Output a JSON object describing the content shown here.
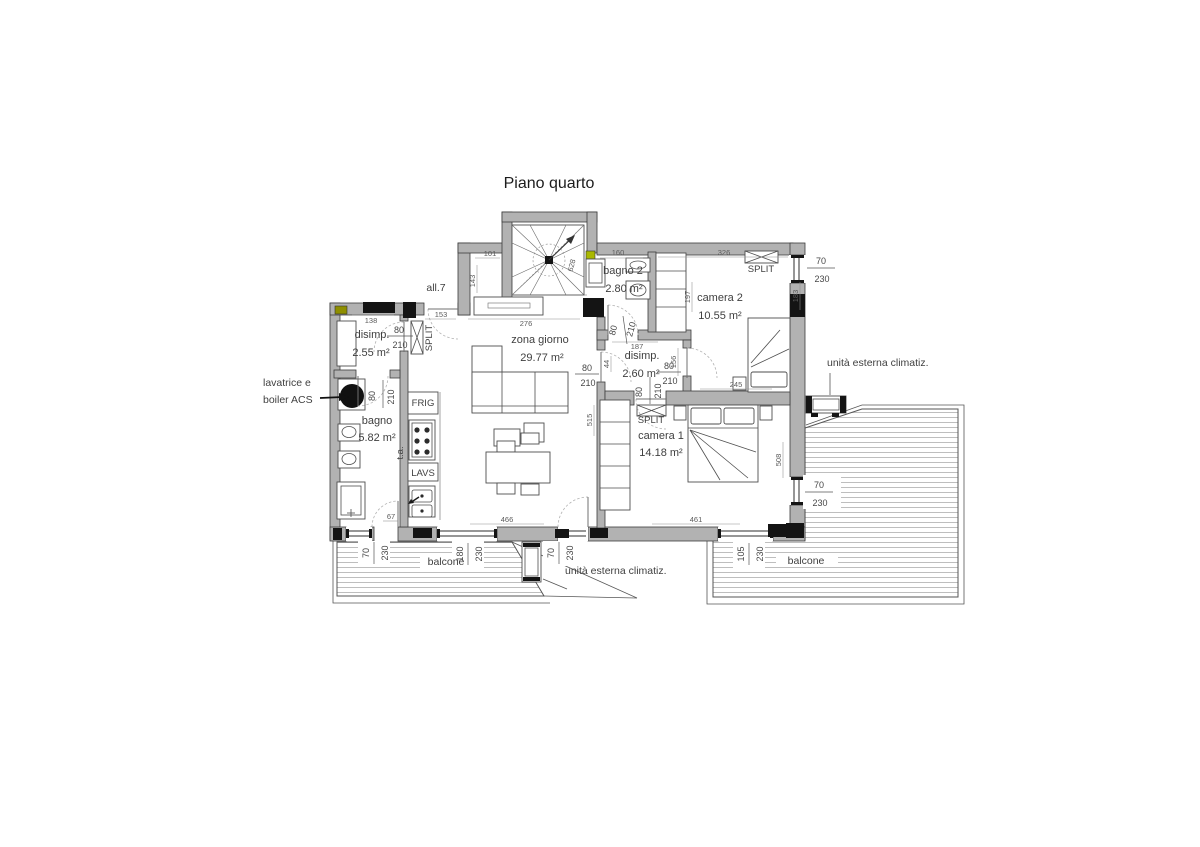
{
  "title": "Piano quarto",
  "rooms": {
    "disimp1": {
      "name": "disimp.",
      "area": "2.55 m²"
    },
    "bagno": {
      "name": "bagno",
      "area": "5.82 m²"
    },
    "zona": {
      "name": "zona giorno",
      "area": "29.77 m²"
    },
    "bagno2": {
      "name": "bagno 2",
      "area": "2.80 m²"
    },
    "camera2": {
      "name": "camera 2",
      "area": "10.55 m²"
    },
    "disimp2": {
      "name": "disimp.",
      "area": "2.60 m²"
    },
    "camera1": {
      "name": "camera 1",
      "area": "14.18 m²"
    }
  },
  "annotations": {
    "allacciamento": "all.7",
    "lavatrice_line1": "lavatrice e",
    "lavatrice_line2": "boiler ACS",
    "unita_esterna_right": "unità esterna climatiz.",
    "unita_esterna_bottom": "unità esterna climatiz.",
    "balcone_left": "balcone",
    "balcone_right": "balcone",
    "split": "SPLIT",
    "frig": "FRIG",
    "lavs": "LAVS",
    "ta": "t.a."
  },
  "door_dim": {
    "w": "80",
    "h": "210"
  },
  "windows": {
    "bagno": {
      "w": "70",
      "h": "230"
    },
    "cucina": {
      "w": "180",
      "h": "230"
    },
    "soggiorno": {
      "w": "70",
      "h": "230"
    },
    "camera1_sud": {
      "w": "105",
      "h": "230"
    },
    "camera2_est": {
      "w": "70",
      "h": "230"
    },
    "camera1_est": {
      "w": "70",
      "h": "230"
    }
  },
  "linear_dims": {
    "d101": "101",
    "d143": "143",
    "d153": "153",
    "d138": "138",
    "d276": "276",
    "d160": "160",
    "d326": "326",
    "d187": "187",
    "d245": "245",
    "d197": "197",
    "d156": "156",
    "d44": "44",
    "d515": "515",
    "d508": "508",
    "d183": "183",
    "d466": "466",
    "d461": "461",
    "d67": "67",
    "d628": "628"
  }
}
